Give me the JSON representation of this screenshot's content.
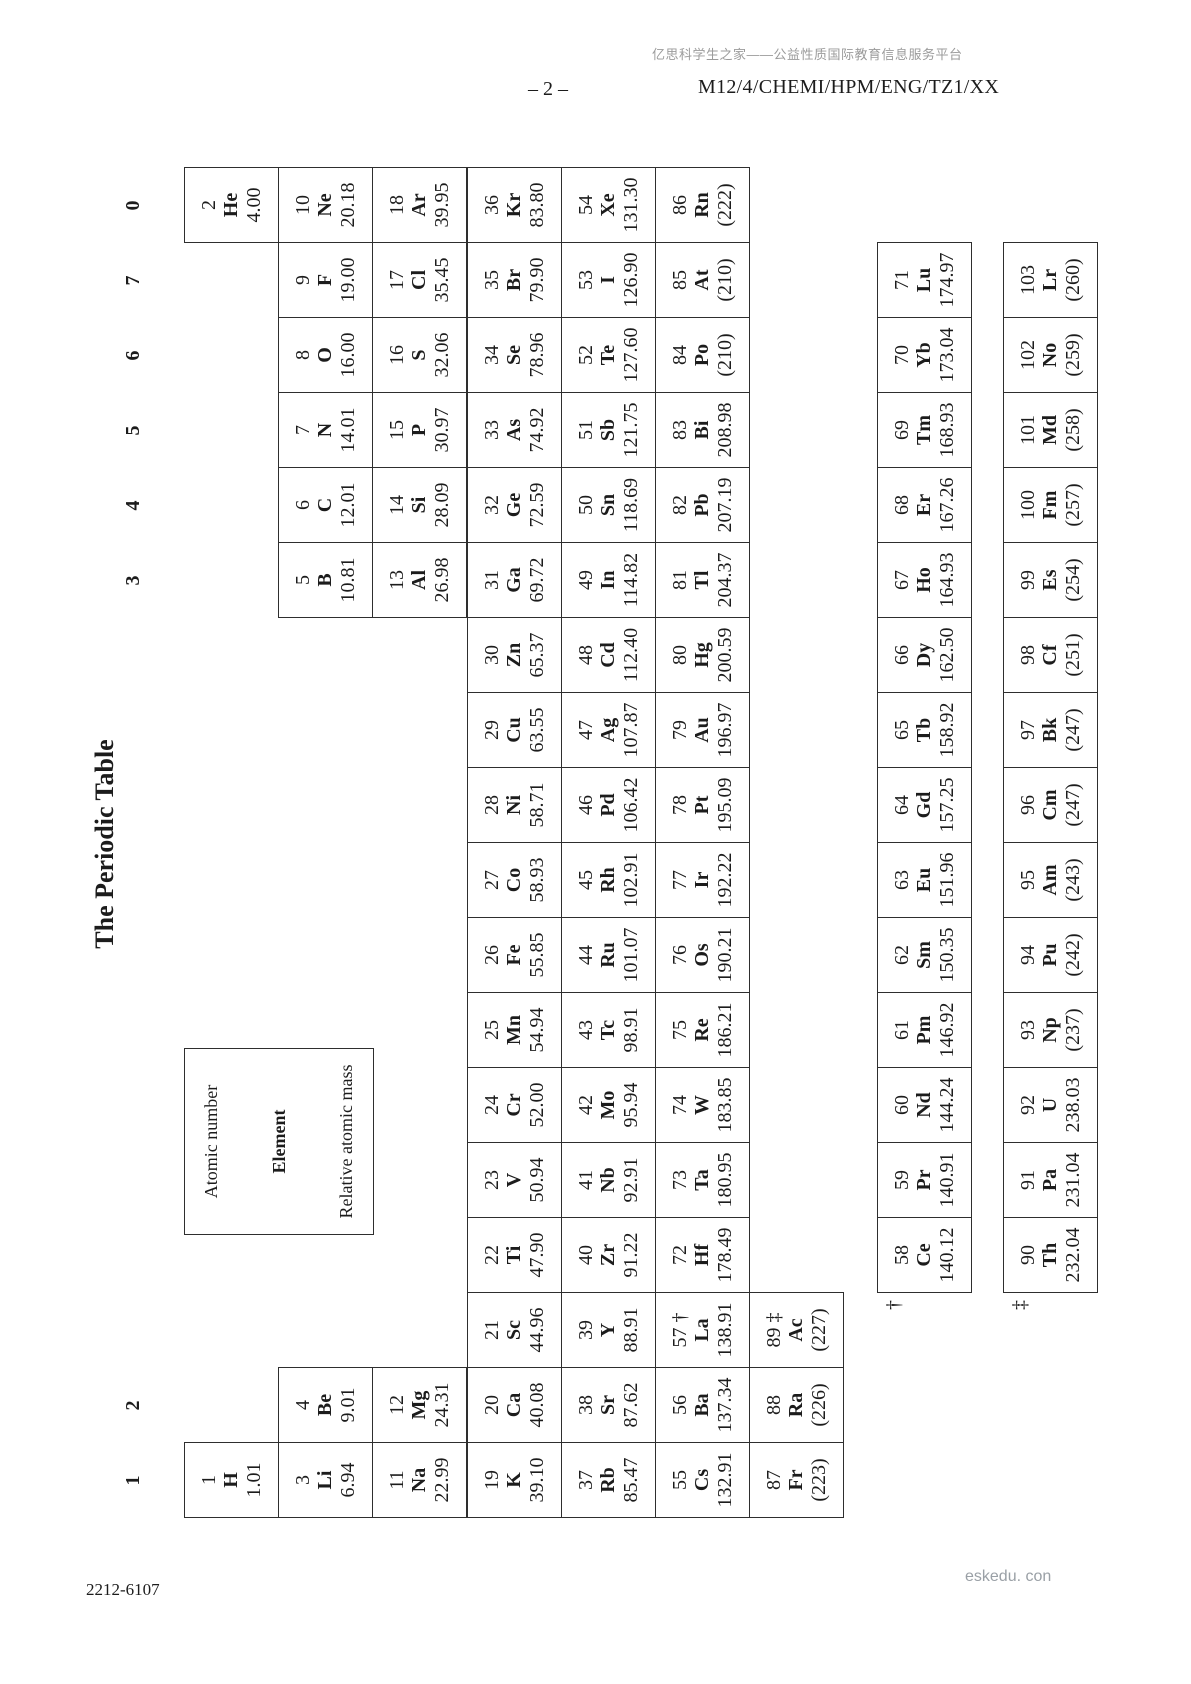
{
  "page": {
    "header": {
      "site_note": "亿思科学生之家——公益性质国际教育信息服务平台",
      "page_number": "– 2 –",
      "paper_code": "M12/4/CHEMI/HPM/ENG/TZ1/XX"
    },
    "footer": {
      "doc_code": "2212-6107",
      "watermark": "eskedu. con"
    }
  },
  "table": {
    "title": "The Periodic Table",
    "legend": {
      "atomic_number": "Atomic number",
      "element": "Element",
      "relative_atomic_mass": "Relative atomic mass"
    },
    "footnotes": {
      "lanthanide_marker": "†",
      "actinide_marker": "‡"
    },
    "group_labels": [
      {
        "label": "1",
        "col": 1
      },
      {
        "label": "2",
        "col": 2
      },
      {
        "label": "3",
        "col": 13
      },
      {
        "label": "4",
        "col": 14
      },
      {
        "label": "5",
        "col": 15
      },
      {
        "label": "6",
        "col": 16
      },
      {
        "label": "7",
        "col": 17
      },
      {
        "label": "0",
        "col": 18
      }
    ],
    "elements": [
      {
        "n": "1",
        "sym": "H",
        "mass": "1.01",
        "row": 1,
        "col": 1
      },
      {
        "n": "2",
        "sym": "He",
        "mass": "4.00",
        "row": 1,
        "col": 18
      },
      {
        "n": "3",
        "sym": "Li",
        "mass": "6.94",
        "row": 2,
        "col": 1
      },
      {
        "n": "4",
        "sym": "Be",
        "mass": "9.01",
        "row": 2,
        "col": 2
      },
      {
        "n": "5",
        "sym": "B",
        "mass": "10.81",
        "row": 2,
        "col": 13
      },
      {
        "n": "6",
        "sym": "C",
        "mass": "12.01",
        "row": 2,
        "col": 14
      },
      {
        "n": "7",
        "sym": "N",
        "mass": "14.01",
        "row": 2,
        "col": 15
      },
      {
        "n": "8",
        "sym": "O",
        "mass": "16.00",
        "row": 2,
        "col": 16
      },
      {
        "n": "9",
        "sym": "F",
        "mass": "19.00",
        "row": 2,
        "col": 17
      },
      {
        "n": "10",
        "sym": "Ne",
        "mass": "20.18",
        "row": 2,
        "col": 18
      },
      {
        "n": "11",
        "sym": "Na",
        "mass": "22.99",
        "row": 3,
        "col": 1
      },
      {
        "n": "12",
        "sym": "Mg",
        "mass": "24.31",
        "row": 3,
        "col": 2
      },
      {
        "n": "13",
        "sym": "Al",
        "mass": "26.98",
        "row": 3,
        "col": 13
      },
      {
        "n": "14",
        "sym": "Si",
        "mass": "28.09",
        "row": 3,
        "col": 14
      },
      {
        "n": "15",
        "sym": "P",
        "mass": "30.97",
        "row": 3,
        "col": 15
      },
      {
        "n": "16",
        "sym": "S",
        "mass": "32.06",
        "row": 3,
        "col": 16
      },
      {
        "n": "17",
        "sym": "Cl",
        "mass": "35.45",
        "row": 3,
        "col": 17
      },
      {
        "n": "18",
        "sym": "Ar",
        "mass": "39.95",
        "row": 3,
        "col": 18
      },
      {
        "n": "19",
        "sym": "K",
        "mass": "39.10",
        "row": 4,
        "col": 1
      },
      {
        "n": "20",
        "sym": "Ca",
        "mass": "40.08",
        "row": 4,
        "col": 2
      },
      {
        "n": "21",
        "sym": "Sc",
        "mass": "44.96",
        "row": 4,
        "col": 3
      },
      {
        "n": "22",
        "sym": "Ti",
        "mass": "47.90",
        "row": 4,
        "col": 4
      },
      {
        "n": "23",
        "sym": "V",
        "mass": "50.94",
        "row": 4,
        "col": 5
      },
      {
        "n": "24",
        "sym": "Cr",
        "mass": "52.00",
        "row": 4,
        "col": 6
      },
      {
        "n": "25",
        "sym": "Mn",
        "mass": "54.94",
        "row": 4,
        "col": 7
      },
      {
        "n": "26",
        "sym": "Fe",
        "mass": "55.85",
        "row": 4,
        "col": 8
      },
      {
        "n": "27",
        "sym": "Co",
        "mass": "58.93",
        "row": 4,
        "col": 9
      },
      {
        "n": "28",
        "sym": "Ni",
        "mass": "58.71",
        "row": 4,
        "col": 10
      },
      {
        "n": "29",
        "sym": "Cu",
        "mass": "63.55",
        "row": 4,
        "col": 11
      },
      {
        "n": "30",
        "sym": "Zn",
        "mass": "65.37",
        "row": 4,
        "col": 12
      },
      {
        "n": "31",
        "sym": "Ga",
        "mass": "69.72",
        "row": 4,
        "col": 13
      },
      {
        "n": "32",
        "sym": "Ge",
        "mass": "72.59",
        "row": 4,
        "col": 14
      },
      {
        "n": "33",
        "sym": "As",
        "mass": "74.92",
        "row": 4,
        "col": 15
      },
      {
        "n": "34",
        "sym": "Se",
        "mass": "78.96",
        "row": 4,
        "col": 16
      },
      {
        "n": "35",
        "sym": "Br",
        "mass": "79.90",
        "row": 4,
        "col": 17
      },
      {
        "n": "36",
        "sym": "Kr",
        "mass": "83.80",
        "row": 4,
        "col": 18
      },
      {
        "n": "37",
        "sym": "Rb",
        "mass": "85.47",
        "row": 5,
        "col": 1
      },
      {
        "n": "38",
        "sym": "Sr",
        "mass": "87.62",
        "row": 5,
        "col": 2
      },
      {
        "n": "39",
        "sym": "Y",
        "mass": "88.91",
        "row": 5,
        "col": 3
      },
      {
        "n": "40",
        "sym": "Zr",
        "mass": "91.22",
        "row": 5,
        "col": 4
      },
      {
        "n": "41",
        "sym": "Nb",
        "mass": "92.91",
        "row": 5,
        "col": 5
      },
      {
        "n": "42",
        "sym": "Mo",
        "mass": "95.94",
        "row": 5,
        "col": 6
      },
      {
        "n": "43",
        "sym": "Tc",
        "mass": "98.91",
        "row": 5,
        "col": 7
      },
      {
        "n": "44",
        "sym": "Ru",
        "mass": "101.07",
        "row": 5,
        "col": 8
      },
      {
        "n": "45",
        "sym": "Rh",
        "mass": "102.91",
        "row": 5,
        "col": 9
      },
      {
        "n": "46",
        "sym": "Pd",
        "mass": "106.42",
        "row": 5,
        "col": 10
      },
      {
        "n": "47",
        "sym": "Ag",
        "mass": "107.87",
        "row": 5,
        "col": 11
      },
      {
        "n": "48",
        "sym": "Cd",
        "mass": "112.40",
        "row": 5,
        "col": 12
      },
      {
        "n": "49",
        "sym": "In",
        "mass": "114.82",
        "row": 5,
        "col": 13
      },
      {
        "n": "50",
        "sym": "Sn",
        "mass": "118.69",
        "row": 5,
        "col": 14
      },
      {
        "n": "51",
        "sym": "Sb",
        "mass": "121.75",
        "row": 5,
        "col": 15
      },
      {
        "n": "52",
        "sym": "Te",
        "mass": "127.60",
        "row": 5,
        "col": 16
      },
      {
        "n": "53",
        "sym": "I",
        "mass": "126.90",
        "row": 5,
        "col": 17
      },
      {
        "n": "54",
        "sym": "Xe",
        "mass": "131.30",
        "row": 5,
        "col": 18
      },
      {
        "n": "55",
        "sym": "Cs",
        "mass": "132.91",
        "row": 6,
        "col": 1
      },
      {
        "n": "56",
        "sym": "Ba",
        "mass": "137.34",
        "row": 6,
        "col": 2
      },
      {
        "n": "57",
        "sym": "La",
        "mass": "138.91",
        "row": 6,
        "col": 3,
        "marker": "†"
      },
      {
        "n": "72",
        "sym": "Hf",
        "mass": "178.49",
        "row": 6,
        "col": 4
      },
      {
        "n": "73",
        "sym": "Ta",
        "mass": "180.95",
        "row": 6,
        "col": 5
      },
      {
        "n": "74",
        "sym": "W",
        "mass": "183.85",
        "row": 6,
        "col": 6
      },
      {
        "n": "75",
        "sym": "Re",
        "mass": "186.21",
        "row": 6,
        "col": 7
      },
      {
        "n": "76",
        "sym": "Os",
        "mass": "190.21",
        "row": 6,
        "col": 8
      },
      {
        "n": "77",
        "sym": "Ir",
        "mass": "192.22",
        "row": 6,
        "col": 9
      },
      {
        "n": "78",
        "sym": "Pt",
        "mass": "195.09",
        "row": 6,
        "col": 10
      },
      {
        "n": "79",
        "sym": "Au",
        "mass": "196.97",
        "row": 6,
        "col": 11
      },
      {
        "n": "80",
        "sym": "Hg",
        "mass": "200.59",
        "row": 6,
        "col": 12
      },
      {
        "n": "81",
        "sym": "Tl",
        "mass": "204.37",
        "row": 6,
        "col": 13
      },
      {
        "n": "82",
        "sym": "Pb",
        "mass": "207.19",
        "row": 6,
        "col": 14
      },
      {
        "n": "83",
        "sym": "Bi",
        "mass": "208.98",
        "row": 6,
        "col": 15
      },
      {
        "n": "84",
        "sym": "Po",
        "mass": "(210)",
        "row": 6,
        "col": 16
      },
      {
        "n": "85",
        "sym": "At",
        "mass": "(210)",
        "row": 6,
        "col": 17
      },
      {
        "n": "86",
        "sym": "Rn",
        "mass": "(222)",
        "row": 6,
        "col": 18
      },
      {
        "n": "87",
        "sym": "Fr",
        "mass": "(223)",
        "row": 7,
        "col": 1
      },
      {
        "n": "88",
        "sym": "Ra",
        "mass": "(226)",
        "row": 7,
        "col": 2
      },
      {
        "n": "89",
        "sym": "Ac",
        "mass": "(227)",
        "row": 7,
        "col": 3,
        "marker": "‡"
      }
    ],
    "lanthanides": [
      {
        "n": "58",
        "sym": "Ce",
        "mass": "140.12"
      },
      {
        "n": "59",
        "sym": "Pr",
        "mass": "140.91"
      },
      {
        "n": "60",
        "sym": "Nd",
        "mass": "144.24"
      },
      {
        "n": "61",
        "sym": "Pm",
        "mass": "146.92"
      },
      {
        "n": "62",
        "sym": "Sm",
        "mass": "150.35"
      },
      {
        "n": "63",
        "sym": "Eu",
        "mass": "151.96"
      },
      {
        "n": "64",
        "sym": "Gd",
        "mass": "157.25"
      },
      {
        "n": "65",
        "sym": "Tb",
        "mass": "158.92"
      },
      {
        "n": "66",
        "sym": "Dy",
        "mass": "162.50"
      },
      {
        "n": "67",
        "sym": "Ho",
        "mass": "164.93"
      },
      {
        "n": "68",
        "sym": "Er",
        "mass": "167.26"
      },
      {
        "n": "69",
        "sym": "Tm",
        "mass": "168.93"
      },
      {
        "n": "70",
        "sym": "Yb",
        "mass": "173.04"
      },
      {
        "n": "71",
        "sym": "Lu",
        "mass": "174.97"
      }
    ],
    "actinides": [
      {
        "n": "90",
        "sym": "Th",
        "mass": "232.04"
      },
      {
        "n": "91",
        "sym": "Pa",
        "mass": "231.04"
      },
      {
        "n": "92",
        "sym": "U",
        "mass": "238.03"
      },
      {
        "n": "93",
        "sym": "Np",
        "mass": "(237)"
      },
      {
        "n": "94",
        "sym": "Pu",
        "mass": "(242)"
      },
      {
        "n": "95",
        "sym": "Am",
        "mass": "(243)"
      },
      {
        "n": "96",
        "sym": "Cm",
        "mass": "(247)"
      },
      {
        "n": "97",
        "sym": "Bk",
        "mass": "(247)"
      },
      {
        "n": "98",
        "sym": "Cf",
        "mass": "(251)"
      },
      {
        "n": "99",
        "sym": "Es",
        "mass": "(254)"
      },
      {
        "n": "100",
        "sym": "Fm",
        "mass": "(257)"
      },
      {
        "n": "101",
        "sym": "Md",
        "mass": "(258)"
      },
      {
        "n": "102",
        "sym": "No",
        "mass": "(259)"
      },
      {
        "n": "103",
        "sym": "Lr",
        "mass": "(260)"
      }
    ]
  },
  "colors": {
    "border": "#2e2e2e",
    "text": "#1c1c1c",
    "muted_grey": "#9b9b9b"
  }
}
